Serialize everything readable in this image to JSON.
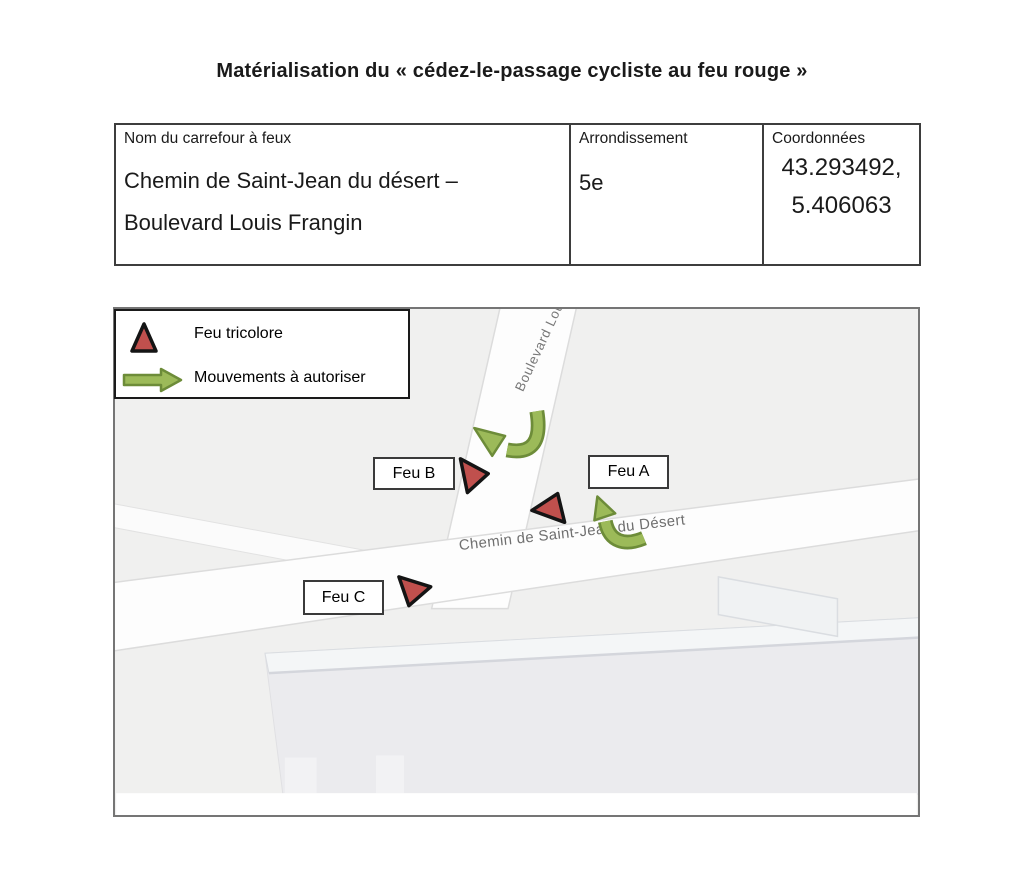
{
  "title": "Matérialisation du « cédez-le-passage cycliste au feu rouge »",
  "table": {
    "columns": [
      {
        "header": "Nom du carrefour à feux",
        "value_lines": [
          "Chemin de Saint-Jean du désert –",
          "Boulevard Louis Frangin"
        ]
      },
      {
        "header": "Arrondissement",
        "value_lines": [
          "5e"
        ]
      },
      {
        "header": "Coordonnées",
        "value_lines": [
          "43.293492,",
          "5.406063"
        ]
      }
    ]
  },
  "map": {
    "legend": {
      "items": [
        {
          "icon": "traffic-light-triangle-icon",
          "label": "Feu tricolore"
        },
        {
          "icon": "movement-arrow-icon",
          "label": "Mouvements à autoriser"
        }
      ]
    },
    "street_labels": {
      "boulevard": "Boulevard Lou",
      "chemin": "Chemin de Saint-Jean du Désert"
    },
    "signals": {
      "feu_a": "Feu A",
      "feu_b": "Feu B",
      "feu_c": "Feu C"
    }
  },
  "colors": {
    "signal_red": "#c0504d",
    "movement_green": "#9cba59",
    "movement_green_border": "#6d8c39",
    "map_background": "#f0f0ef",
    "road_white": "#fdfdfd",
    "street_label_gray": "#6f6f6f"
  }
}
